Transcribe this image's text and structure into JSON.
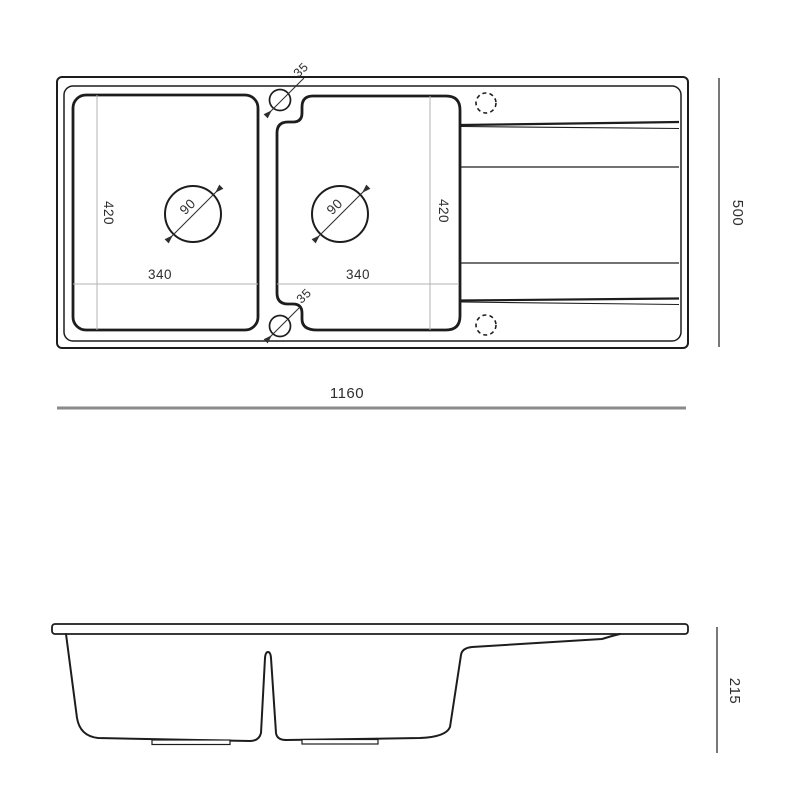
{
  "drawing": {
    "type": "technical-drawing-kitchen-sink",
    "line_color": "#1d1d1d",
    "dim_line_color": "#8a8a8a",
    "dim_text_color": "#2e2e2e",
    "top_view": {
      "overall_width": "1160",
      "overall_depth": "500",
      "left_bowl": {
        "depth": "420",
        "width": "340",
        "drain_diameter": "90"
      },
      "right_bowl": {
        "depth": "420",
        "width": "340",
        "drain_diameter": "90"
      },
      "tap_hole_top_offset": "35",
      "tap_hole_bottom_offset": "35"
    },
    "side_view": {
      "overall_height": "215"
    }
  }
}
